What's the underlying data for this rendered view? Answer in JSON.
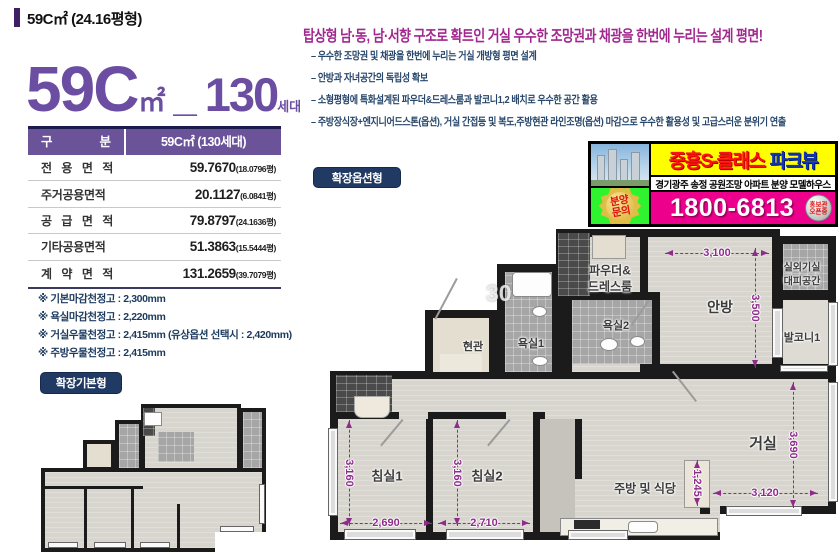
{
  "header": {
    "small_title": "59C㎡ (24.16평형)"
  },
  "title": {
    "big": "59C",
    "unit": "㎡",
    "sep": "_",
    "count": "130",
    "count_unit": "세대"
  },
  "area_table": {
    "head_left": "구 분",
    "head_right": "59C㎡ (130세대)",
    "rows": [
      {
        "label": "전 용 면 적",
        "value": "59.7670",
        "sub": "(18.0796평)"
      },
      {
        "label": "주거공용면적",
        "value": "20.1127",
        "sub": "(6.0841평)"
      },
      {
        "label": "공 급 면 적",
        "value": "79.8797",
        "sub": "(24.1636평)"
      },
      {
        "label": "기타공용면적",
        "value": "51.3863",
        "sub": "(15.5444평)"
      },
      {
        "label": "계 약 면 적",
        "value": "131.2659",
        "sub": "(39.7079평)"
      }
    ]
  },
  "notes": [
    "※ 기본마감천정고 : 2,300mm",
    "※ 욕실마감천정고 : 2,220mm",
    "※ 거실우물천정고 : 2,415mm (유상옵션 선택시 : 2,420mm)",
    "※ 주방우물천정고 : 2,415mm"
  ],
  "badges": {
    "basic": "확장기본형",
    "option": "확장옵션형"
  },
  "feature": {
    "headline": "탑상형 남·동, 남·서향 구조로 확트인 거실 우수한 조망권과 채광을 한번에 누리는 설계 평면!",
    "bullets": [
      "– 우수한 조망권 및 채광을 한번에 누리는 거실 개방형 평면 설계",
      "– 안방과 자녀공간의 독립성 확보",
      "– 소형평형에 특화설계된 파우더&드레스룸과 발코니1,2 배치로 우수한 공간 활용",
      "– 주방장식장+엔지니어드스톤(옵션), 거실 간접등 및 복도,주방현관 라인조명(옵션) 마감으로 우수한 활용성 및 고급스러운 분위기 연출"
    ]
  },
  "ad": {
    "brand_red": "중흥S-클래스",
    "brand_blue": "파크뷰",
    "strip": "경기광주 송정  공원조망 아파트 분양 모델하우스",
    "phone": "1800-6813",
    "inquiry_line1": "분양",
    "inquiry_line2": "문의",
    "badge_line1": "홍보관",
    "badge_line2": "오픈중"
  },
  "floorplan": {
    "watermark": "30",
    "rooms": {
      "powder1": "파우더&",
      "powder2": "드레스룸",
      "anbang": "안방",
      "outdoor1": "실외기실",
      "outdoor2": "대피공간",
      "balcony": "발코니1",
      "bath2": "욕실2",
      "bath1": "욕실1",
      "entrance": "현관",
      "bed1": "침실1",
      "bed2": "침실2",
      "living": "거실",
      "kitchen": "주방 및 식당"
    },
    "dims": {
      "anbang_w": "3,100",
      "anbang_h": "3,500",
      "bed1_h": "3,160",
      "bed1_w": "2,690",
      "bed2_h": "3,160",
      "bed2_w": "2,710",
      "living_h": "3,690",
      "living_w": "3,120",
      "kitchen_w": "1,245"
    }
  },
  "colors": {
    "purple": "#6b4ea2",
    "magenta": "#a1278f",
    "navy": "#1c3a5e",
    "dim_purple": "#8e2c8c",
    "table_header_bg": "#6a5399",
    "badge_bg": "#203a63",
    "ad_magenta": "#ec008c",
    "ad_yellow": "#ffff00"
  }
}
